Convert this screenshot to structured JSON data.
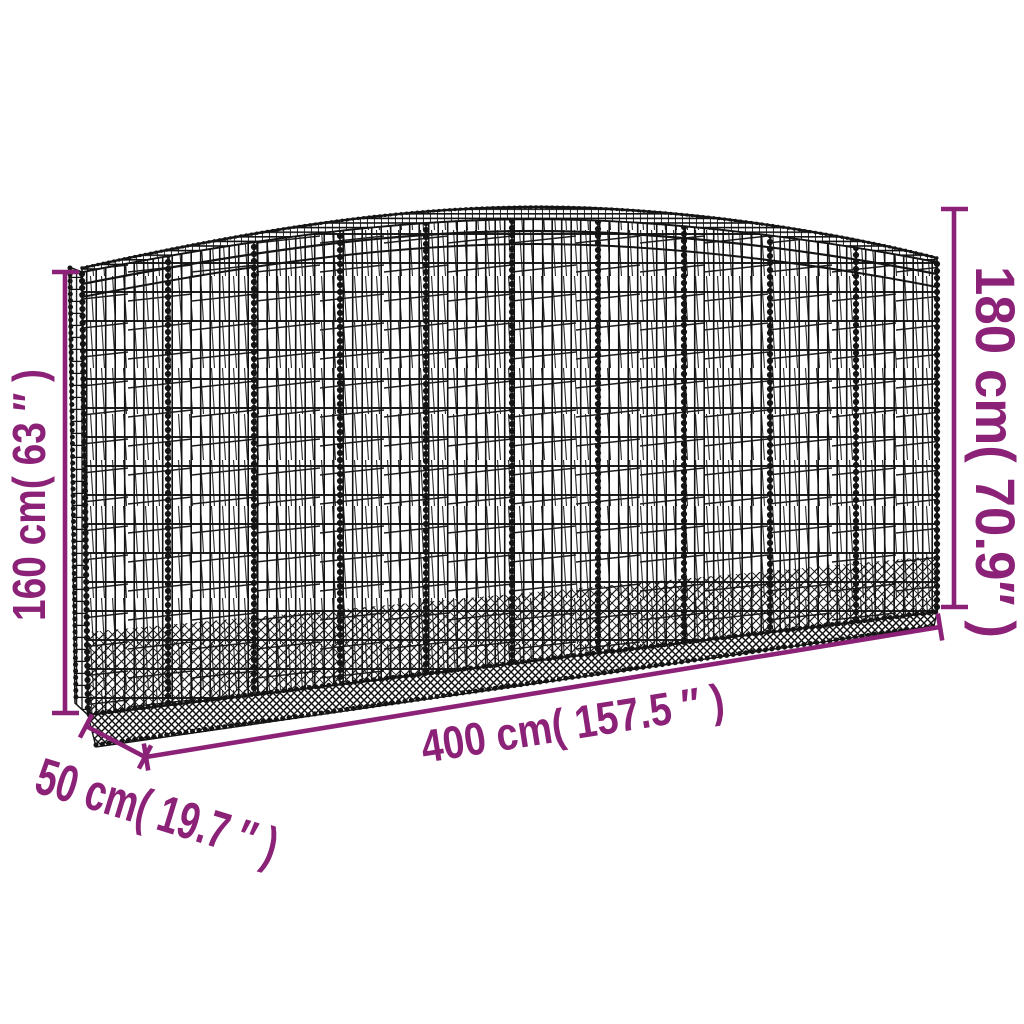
{
  "colors": {
    "accent": "#8B2277",
    "wire": "#141414",
    "background": "#ffffff"
  },
  "diagram": {
    "type": "product-dimension-diagram",
    "subject": "arched gabion wire-mesh basket",
    "dimensions": {
      "side_height": {
        "value_cm": 160,
        "value_in": 63,
        "label": "160 cm( 63 ″ )"
      },
      "arch_height": {
        "value_cm": 180,
        "value_in": 70.9,
        "label": "180 cm( 70.9″ )"
      },
      "length": {
        "value_cm": 400,
        "value_in": 157.5,
        "label": "400 cm( 157.5 ″ )"
      },
      "depth": {
        "value_cm": 50,
        "value_in": 19.7,
        "label": "50 cm( 19.7 ″ )"
      }
    }
  }
}
